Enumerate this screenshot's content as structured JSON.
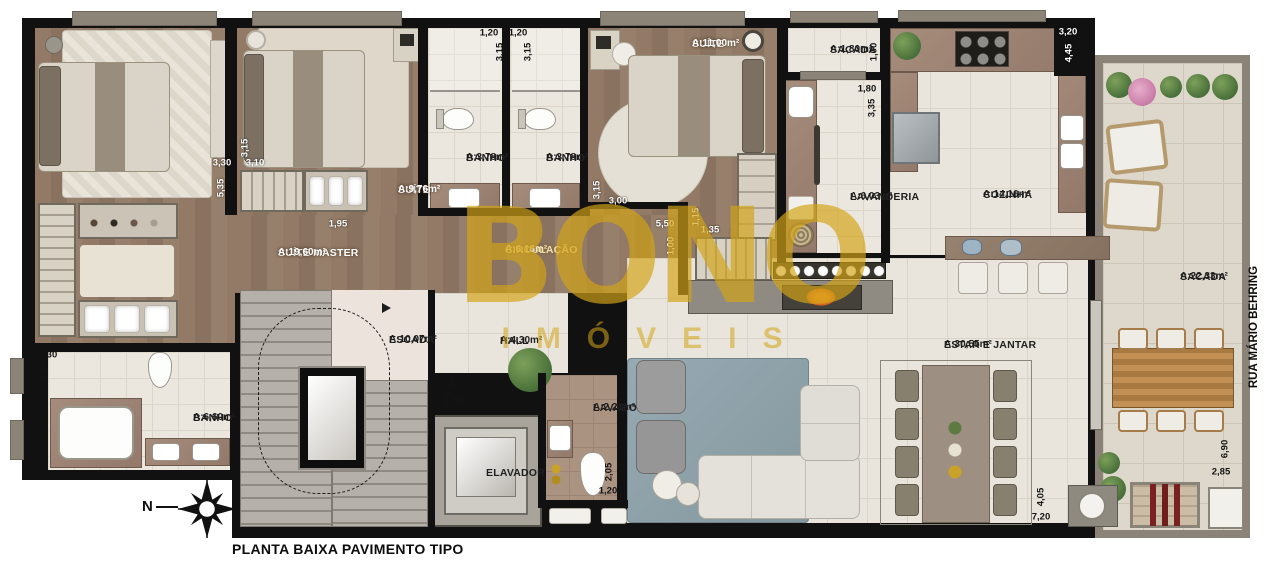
{
  "title": "PLANTA BAIXA PAVIMENTO TIPO",
  "street_label": "RUA MÁRIO BEHRING",
  "compass": {
    "north_letter": "N"
  },
  "watermark": {
    "line1": "BONO",
    "line2": "IMÓVEIS"
  },
  "colors": {
    "wall": "#111111",
    "lintel": "#8d8478",
    "wood": "#8d7663",
    "tile": "#ebe7df",
    "tileLarge": "#e9e5dc",
    "sacadaTile": "#ddd8cb",
    "sacadaWall": "#8b8377",
    "counter": "#9b8474",
    "gold": "#d3a416",
    "rugBlue": "#8fa3ad"
  },
  "rooms": [
    {
      "id": "suite-master",
      "line1": "SUÍTE MASTER",
      "line2": "A:19,60m²",
      "x": 278,
      "y": 247,
      "tone": "light"
    },
    {
      "id": "suite-976",
      "line1": "SUÍTE",
      "line2": "A:9,76m²",
      "x": 398,
      "y": 184,
      "tone": "light"
    },
    {
      "id": "banho-1",
      "line1": "BANHO",
      "line2": "A:3,78m²",
      "x": 466,
      "y": 152,
      "tone": "dark"
    },
    {
      "id": "banho-2",
      "line1": "BANHO",
      "line2": "A:3,78m²",
      "x": 546,
      "y": 152,
      "tone": "dark"
    },
    {
      "id": "suite-11",
      "line1": "SUÍTE",
      "line2": "A:11,00m²",
      "x": 692,
      "y": 38,
      "tone": "light"
    },
    {
      "id": "sacada-servico",
      "line1": "SACADA",
      "line2": "A:1,80m²",
      "x": 830,
      "y": 44,
      "tone": "dark"
    },
    {
      "id": "lavanderia",
      "line1": "LAVANDERIA",
      "line2": "A:6,03m²",
      "x": 850,
      "y": 191,
      "tone": "dark"
    },
    {
      "id": "cozinha",
      "line1": "COZINHA",
      "line2": "A:14,16m²",
      "x": 983,
      "y": 189,
      "tone": "dark"
    },
    {
      "id": "sacada-gourmet",
      "line1": "SACADA",
      "line2": "A:22,33m²",
      "x": 1180,
      "y": 271,
      "tone": "dark"
    },
    {
      "id": "circulacao",
      "line1": "CIRCULAÇÃO",
      "line2": "A:6,16m²",
      "x": 505,
      "y": 244,
      "tone": "gold"
    },
    {
      "id": "banho-master",
      "line1": "BANHO",
      "line2": "A:6,60m²",
      "x": 193,
      "y": 412,
      "tone": "dark"
    },
    {
      "id": "escada",
      "line1": "ESCADA",
      "line2": "A:10,07m²",
      "x": 389,
      "y": 334,
      "tone": "dark"
    },
    {
      "id": "hall",
      "line1": "HALL",
      "line2": "A:4,30m²",
      "x": 500,
      "y": 335,
      "tone": "dark"
    },
    {
      "id": "elevador",
      "line1": "ELAVADOR",
      "line2": "",
      "x": 486,
      "y": 467,
      "tone": "dark"
    },
    {
      "id": "lavabo",
      "line1": "LAVABO",
      "line2": "A:2,21m²",
      "x": 593,
      "y": 402,
      "tone": "dark"
    },
    {
      "id": "estar-jantar",
      "line1": "ESTAR E JANTAR",
      "line2": "A:30,55m²",
      "x": 944,
      "y": 339,
      "tone": "dark"
    }
  ],
  "dimensions": [
    {
      "t": "3,30",
      "x": 222,
      "y": 163,
      "v": false,
      "tone": "light"
    },
    {
      "t": "5,35",
      "x": 221,
      "y": 188,
      "v": true,
      "tone": "light"
    },
    {
      "t": "3,15",
      "x": 245,
      "y": 148,
      "v": true,
      "tone": "light"
    },
    {
      "t": "3,10",
      "x": 255,
      "y": 163,
      "v": false,
      "tone": "light"
    },
    {
      "t": "1,95",
      "x": 338,
      "y": 224,
      "v": false,
      "tone": "light"
    },
    {
      "t": "1,20",
      "x": 489,
      "y": 33,
      "v": false,
      "tone": "dark"
    },
    {
      "t": "1,20",
      "x": 518,
      "y": 33,
      "v": false,
      "tone": "dark"
    },
    {
      "t": "3,15",
      "x": 500,
      "y": 52,
      "v": true,
      "tone": "dark"
    },
    {
      "t": "3,15",
      "x": 528,
      "y": 52,
      "v": true,
      "tone": "dark"
    },
    {
      "t": "3,15",
      "x": 597,
      "y": 190,
      "v": true,
      "tone": "light"
    },
    {
      "t": "3,00",
      "x": 618,
      "y": 201,
      "v": false,
      "tone": "light"
    },
    {
      "t": "5,50",
      "x": 665,
      "y": 224,
      "v": false,
      "tone": "light"
    },
    {
      "t": "1,00",
      "x": 671,
      "y": 246,
      "v": true,
      "tone": "light"
    },
    {
      "t": "1,15",
      "x": 696,
      "y": 217,
      "v": true,
      "tone": "light"
    },
    {
      "t": "1,35",
      "x": 710,
      "y": 230,
      "v": false,
      "tone": "light"
    },
    {
      "t": "1,00",
      "x": 874,
      "y": 52,
      "v": true,
      "tone": "dark"
    },
    {
      "t": "1,80",
      "x": 867,
      "y": 89,
      "v": false,
      "tone": "dark"
    },
    {
      "t": "3,35",
      "x": 872,
      "y": 108,
      "v": true,
      "tone": "dark"
    },
    {
      "t": "3,20",
      "x": 1068,
      "y": 32,
      "v": false,
      "tone": "light"
    },
    {
      "t": "4,45",
      "x": 1069,
      "y": 53,
      "v": true,
      "tone": "light"
    },
    {
      "t": "3,30",
      "x": 48,
      "y": 355,
      "v": false,
      "tone": "dark"
    },
    {
      "t": "2,00",
      "x": 43,
      "y": 371,
      "v": true,
      "tone": "dark"
    },
    {
      "t": "2,10",
      "x": 451,
      "y": 387,
      "v": true,
      "tone": "dark"
    },
    {
      "t": "1,95",
      "x": 454,
      "y": 402,
      "v": false,
      "tone": "dark"
    },
    {
      "t": "2,05",
      "x": 609,
      "y": 472,
      "v": true,
      "tone": "dark"
    },
    {
      "t": "1,20",
      "x": 608,
      "y": 491,
      "v": false,
      "tone": "dark"
    },
    {
      "t": "4,05",
      "x": 1041,
      "y": 497,
      "v": true,
      "tone": "dark"
    },
    {
      "t": "7,20",
      "x": 1041,
      "y": 517,
      "v": false,
      "tone": "dark"
    },
    {
      "t": "6,90",
      "x": 1225,
      "y": 449,
      "v": true,
      "tone": "dark"
    },
    {
      "t": "2,85",
      "x": 1221,
      "y": 472,
      "v": false,
      "tone": "dark"
    }
  ]
}
